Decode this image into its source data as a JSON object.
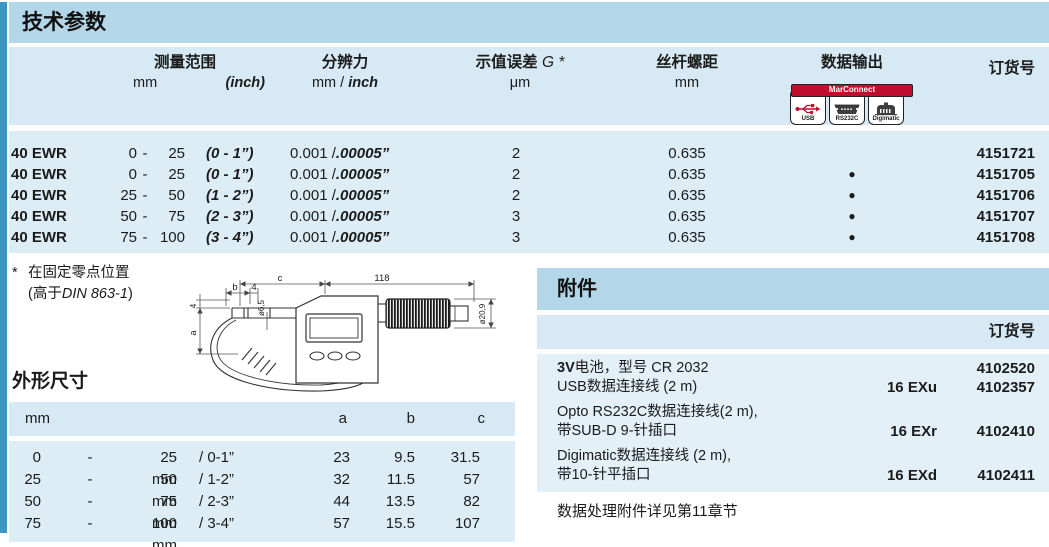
{
  "page": {
    "title": "技术参数"
  },
  "tech": {
    "header": {
      "range": "测量范围",
      "range_mm": "mm",
      "range_inch": "(inch)",
      "res": "分辨力",
      "res_unit_plain": "mm / ",
      "res_unit_em": "inch",
      "err": "示值误差",
      "err_sym": " G *",
      "err_unit": "μm",
      "pitch": "丝杆螺距",
      "pitch_unit": "mm",
      "out": "数据输出",
      "order": "订货号"
    },
    "marconnect": {
      "banner": "MarConnect",
      "usb": "USB",
      "rs232c": "RS232C",
      "digimatic": "Digimatic"
    },
    "rows": [
      {
        "model": "40 EWR",
        "from": "0",
        "dash": "-",
        "to": "25",
        "inch": "(0 - 1”)",
        "res": "0.001 /",
        "res_em": ".00005”",
        "err": "2",
        "pitch": "0.635",
        "out": "",
        "order": "4151721"
      },
      {
        "model": "40 EWR",
        "from": "0",
        "dash": "-",
        "to": "25",
        "inch": "(0 - 1”)",
        "res": "0.001 /",
        "res_em": ".00005”",
        "err": "2",
        "pitch": "0.635",
        "out": "●",
        "order": "4151705"
      },
      {
        "model": "40 EWR",
        "from": "25",
        "dash": "-",
        "to": "50",
        "inch": "(1 - 2”)",
        "res": "0.001 /",
        "res_em": ".00005”",
        "err": "2",
        "pitch": "0.635",
        "out": "●",
        "order": "4151706"
      },
      {
        "model": "40 EWR",
        "from": "50",
        "dash": "-",
        "to": "75",
        "inch": "(2 - 3”)",
        "res": "0.001 /",
        "res_em": ".00005”",
        "err": "3",
        "pitch": "0.635",
        "out": "●",
        "order": "4151707"
      },
      {
        "model": "40 EWR",
        "from": "75",
        "dash": "-",
        "to": "100",
        "inch": "(3 - 4”)",
        "res": "0.001 /",
        "res_em": ".00005”",
        "err": "3",
        "pitch": "0.635",
        "out": "●",
        "order": "4151708"
      }
    ]
  },
  "footnote": {
    "star": "*",
    "line1": "在固定零点位置",
    "line2_open": "(高于",
    "line2_din": "DIN 863-1",
    "line2_close": ")"
  },
  "drawing": {
    "c": "c",
    "len": "118",
    "b": "b",
    "four_top": "4",
    "dia_spindle": "ø6,5",
    "four_left": "4",
    "a": "a",
    "dia_thimble": "ø20,9"
  },
  "dims": {
    "title": "外形尺寸",
    "unit": "mm",
    "col_a": "a",
    "col_b": "b",
    "col_c": "c",
    "rows": [
      {
        "from": "0",
        "dash": "-",
        "to": "25 mm",
        "inch": "/ 0-1”",
        "a": "23",
        "b": "9.5",
        "c": "31.5"
      },
      {
        "from": "25",
        "dash": "-",
        "to": "50 mm",
        "inch": "/ 1-2”",
        "a": "32",
        "b": "11.5",
        "c": "57"
      },
      {
        "from": "50",
        "dash": "-",
        "to": "75 mm",
        "inch": "/ 2-3”",
        "a": "44",
        "b": "13.5",
        "c": "82"
      },
      {
        "from": "75",
        "dash": "-",
        "to": "100 mm",
        "inch": "/ 3-4”",
        "a": "57",
        "b": "15.5",
        "c": "107"
      }
    ]
  },
  "accessories": {
    "title": "附件",
    "order_label": "订货号",
    "items": [
      {
        "bold": "3V",
        "line1": "电池，型号 CR 2032",
        "line2": "",
        "code": "",
        "order": "4102520"
      },
      {
        "bold": "",
        "line1": "USB数据连接线 (2 m)",
        "line2": "",
        "code": "16 EXu",
        "order": "4102357"
      },
      {
        "bold": "",
        "line1": "Opto RS232C数据连接线(2 m),",
        "line2": "带SUB-D 9-针插口",
        "code": "16 EXr",
        "order": "4102410"
      },
      {
        "bold": "",
        "line1": "Digimatic数据连接线 (2 m),",
        "line2": "带10-针平插口",
        "code": "16 EXd",
        "order": "4102411"
      }
    ],
    "note": "数据处理附件详见第11章节"
  },
  "colors": {
    "accent_blue": "#3b96c5",
    "band_medium": "#b4d6e9",
    "band_light": "#d7e9f4",
    "band_rows": "#dcedf6",
    "panel_body": "#e4f0f8",
    "brand_red": "#c00f2e"
  }
}
